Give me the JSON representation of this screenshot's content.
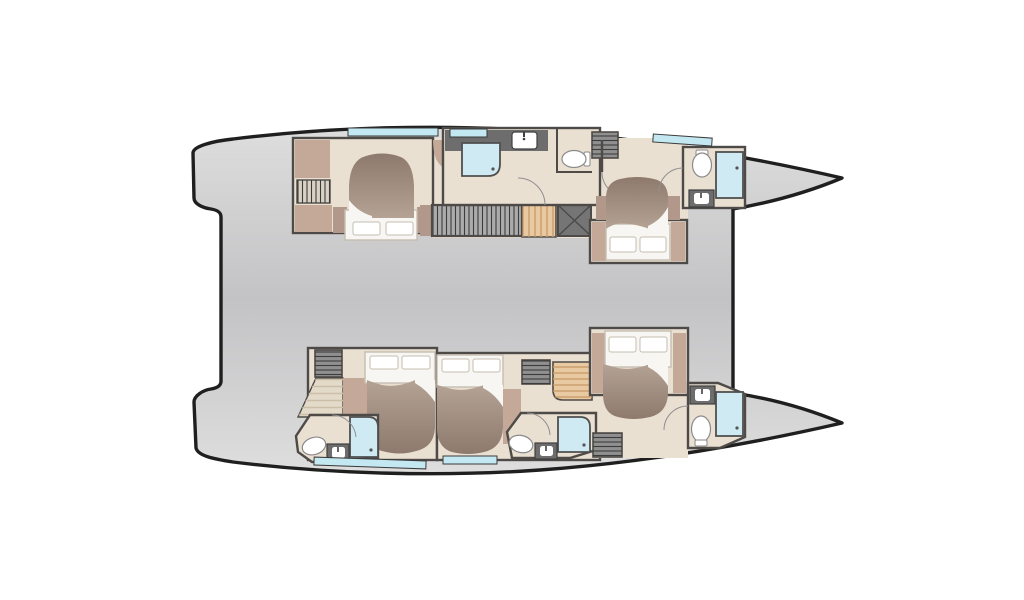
{
  "canvas": {
    "width": 1024,
    "height": 600,
    "background": "#ffffff"
  },
  "palette": {
    "background": "#ffffff",
    "outline": "#1f1f1f",
    "hull_light": "#dedede",
    "hull_mid": "#c3c3c5",
    "wall": "#4e4a47",
    "floor": "#eae0d2",
    "furniture": "#c4a898",
    "furniture_dark": "#b2988a",
    "duvet_light": "#b4a294",
    "duvet_dark": "#8d7a6d",
    "linen": "#f8f6f2",
    "linen_outline": "#c5beb0",
    "window": "#c3e8f1",
    "shower": "#cfeaf3",
    "fixture_unit": "#6d6d6d",
    "fixture_white": "#ffffff",
    "louver_light_bg": "#d9d1c4",
    "louver_dark_bg": "#8f8f8f",
    "louver_stripe": "#3c3c3c",
    "wood": "#e9c9a1",
    "wood_stripe": "#c59a67",
    "hatch": "#757575",
    "stair_beige": "#e4dac9"
  },
  "diagram": {
    "kind": "catamaran-deck-floor-plan-top-view",
    "hulls": [
      {
        "name": "port-hull",
        "rooms": [
          "aft-double-cabin",
          "mid-bathroom",
          "companionway-stairs",
          "forward-double-cabin",
          "bow-bathroom"
        ]
      },
      {
        "name": "starboard-hull",
        "rooms": [
          "aft-double-cabin-ensuite",
          "mid-double-cabin-ensuite",
          "companionway-stairs",
          "forward-double-cabin",
          "bow-bathroom"
        ]
      }
    ],
    "fixtures": [
      "double-bed",
      "pillows",
      "duvet",
      "wardrobe-louver",
      "shelf-louver",
      "toilet",
      "washbasin",
      "shower",
      "staircase",
      "floor-hatch",
      "hull-window",
      "door-swing"
    ]
  }
}
